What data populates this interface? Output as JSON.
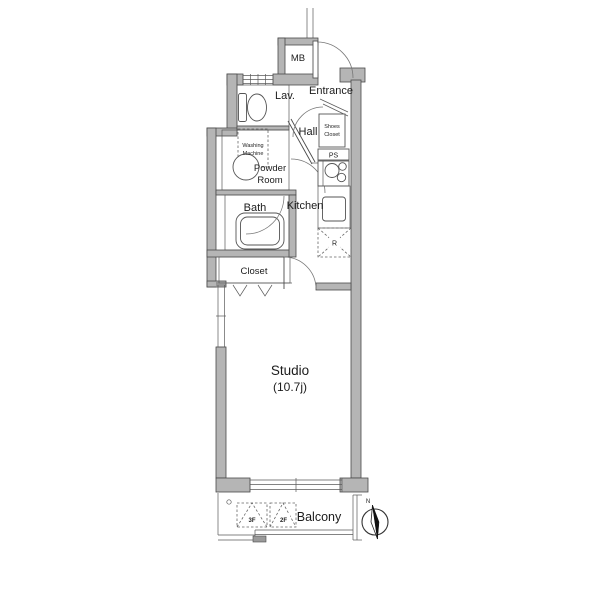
{
  "colors": {
    "background": "#ffffff",
    "wall_fill": "#b5b5b5",
    "line": "#4a4a4a",
    "text": "#1c1c1c"
  },
  "labels": {
    "meter_box": "MB",
    "lavatory": "Lav.",
    "entrance": "Entrance",
    "hall": "Hall",
    "washing_line1": "Washing",
    "washing_line2": "Machine",
    "shoes_line1": "Shoes",
    "shoes_line2": "Closet",
    "powder_line1": "Powder",
    "powder_line2": "Room",
    "pipe_space": "PS",
    "kitchen": "Kitchen",
    "bath": "Bath",
    "refrigerator": "R",
    "closet": "Closet",
    "studio_name": "Studio",
    "studio_size": "(10.7j)",
    "balcony": "Balcony",
    "hatch_3f": "3F",
    "hatch_2f": "2F",
    "compass_north": "N"
  }
}
